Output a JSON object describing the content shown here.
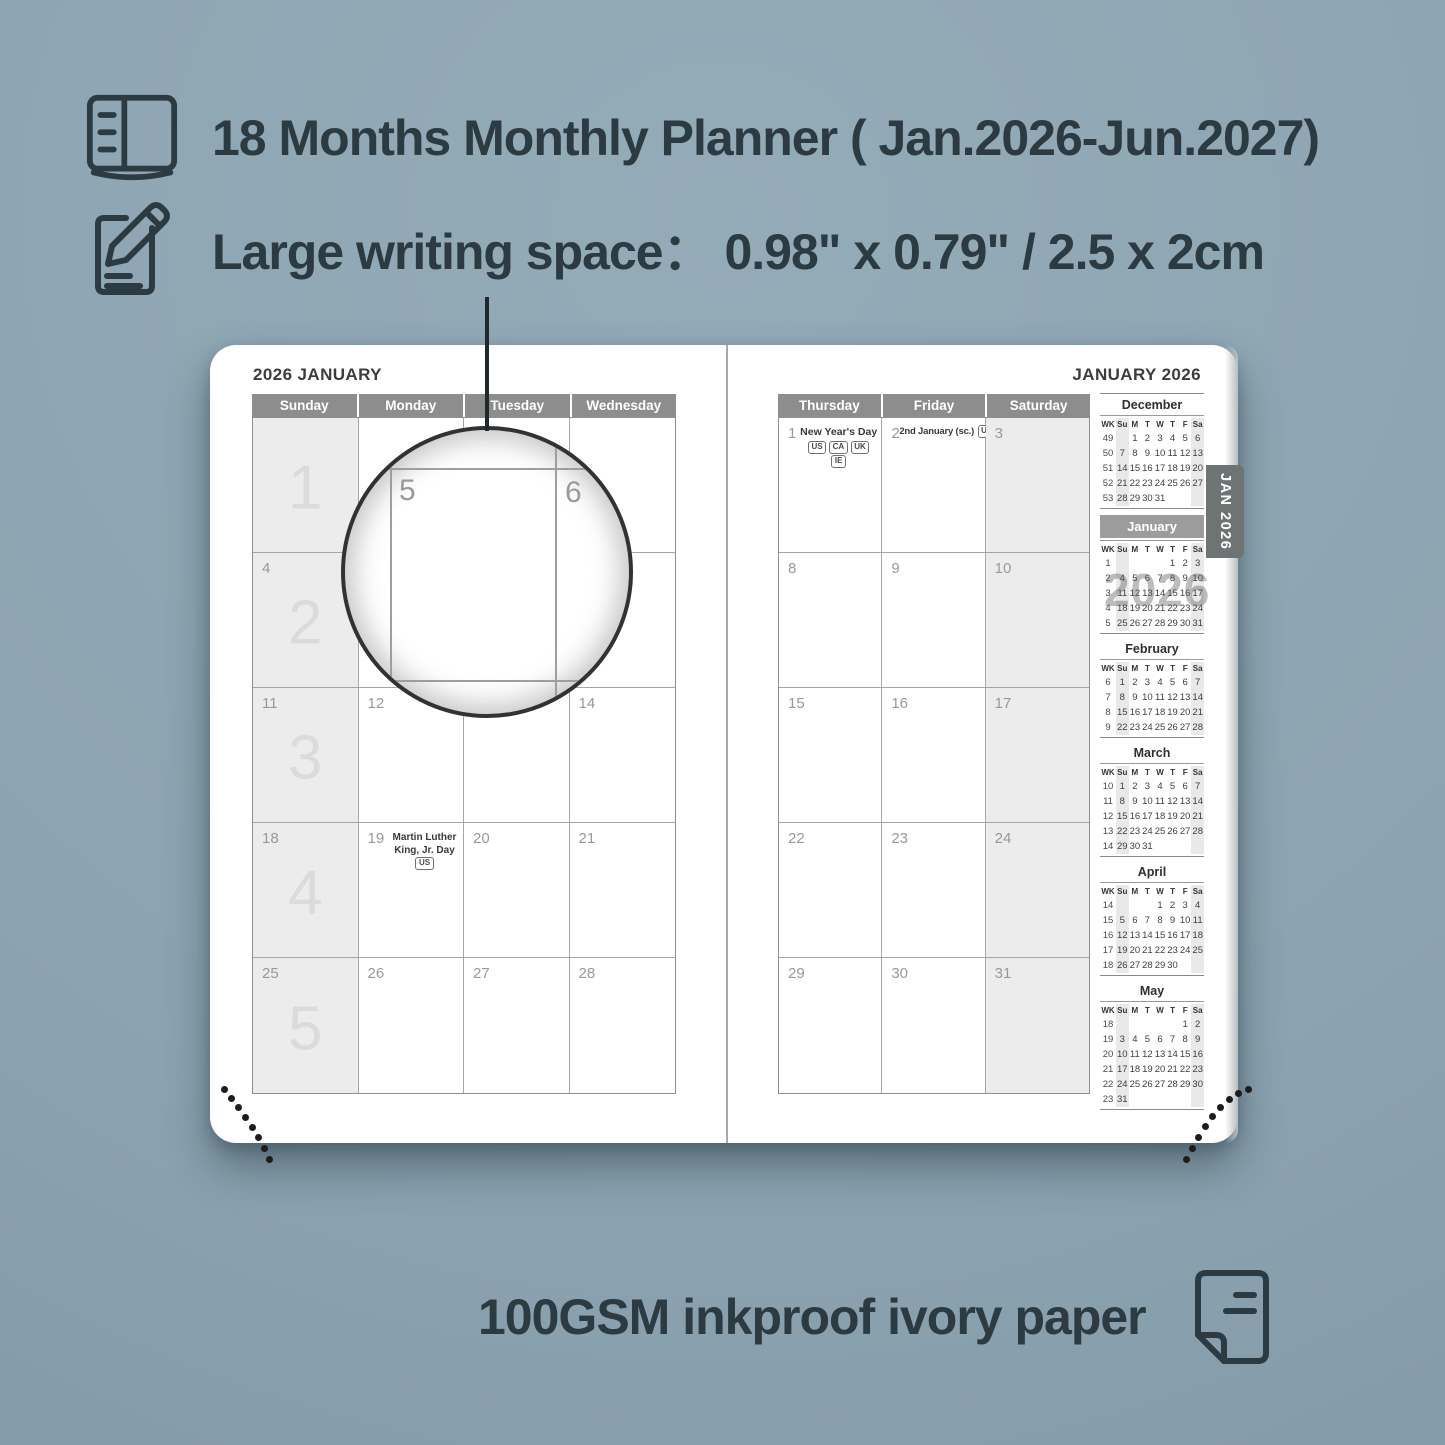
{
  "colors": {
    "background": "#8FA6B3",
    "text_dark": "#2C3A41",
    "day_header_bar": "#8D8D8D",
    "weekend_shade": "#ECECEC",
    "tab_background": "#6E7373",
    "page_background": "#FFFFFF"
  },
  "features": {
    "line1": {
      "icon": "open-planner-icon",
      "text": "18 Months Monthly Planner ( Jan.2026-Jun.2027)"
    },
    "line2": {
      "icon": "pencil-edit-icon",
      "text": "Large writing space：  0.98\" x 0.79\" / 2.5 x 2cm"
    },
    "line3": {
      "icon": "paper-sheet-icon",
      "text": "100GSM inkproof ivory paper"
    }
  },
  "planner": {
    "left_page": {
      "title": "2026 JANUARY",
      "day_headers": [
        "Sunday",
        "Monday",
        "Tuesday",
        "Wednesday"
      ],
      "weeks": [
        {
          "week_number": "1",
          "dates": [
            "",
            "",
            "",
            ""
          ]
        },
        {
          "week_number": "2",
          "dates": [
            "4",
            "5",
            "6",
            "7"
          ]
        },
        {
          "week_number": "3",
          "dates": [
            "11",
            "12",
            "13",
            "14"
          ]
        },
        {
          "week_number": "4",
          "dates": [
            "18",
            "19",
            "20",
            "21"
          ]
        },
        {
          "week_number": "5",
          "dates": [
            "25",
            "26",
            "27",
            "28"
          ]
        }
      ],
      "holiday": {
        "date": "19",
        "name": "Martin Luther King, Jr. Day",
        "badges": [
          "US"
        ]
      }
    },
    "right_page": {
      "title": "JANUARY 2026",
      "day_headers": [
        "Thursday",
        "Friday",
        "Saturday"
      ],
      "weeks": [
        {
          "dates": [
            "1",
            "2",
            "3"
          ]
        },
        {
          "dates": [
            "8",
            "9",
            "10"
          ]
        },
        {
          "dates": [
            "15",
            "16",
            "17"
          ]
        },
        {
          "dates": [
            "22",
            "23",
            "24"
          ]
        },
        {
          "dates": [
            "29",
            "30",
            "31"
          ]
        }
      ],
      "holidays": [
        {
          "date": "1",
          "name": "New Year's Day",
          "badges": [
            "US",
            "CA",
            "UK",
            "IE"
          ]
        },
        {
          "date": "2",
          "name": "2nd January (sc.)",
          "badges": [
            "UK"
          ]
        }
      ]
    },
    "magnifier": {
      "left_date": "5",
      "right_date": "6"
    },
    "side_tab": "JAN 2026",
    "watermark": "2026",
    "mini_calendar_header": [
      "WK",
      "Su",
      "M",
      "T",
      "W",
      "T",
      "F",
      "Sa"
    ],
    "mini_calendars": [
      {
        "month": "December",
        "highlighted": false,
        "weeks": [
          [
            "49",
            "",
            "1",
            "2",
            "3",
            "4",
            "5",
            "6"
          ],
          [
            "50",
            "7",
            "8",
            "9",
            "10",
            "11",
            "12",
            "13"
          ],
          [
            "51",
            "14",
            "15",
            "16",
            "17",
            "18",
            "19",
            "20"
          ],
          [
            "52",
            "21",
            "22",
            "23",
            "24",
            "25",
            "26",
            "27"
          ],
          [
            "53",
            "28",
            "29",
            "30",
            "31",
            "",
            "",
            ""
          ]
        ]
      },
      {
        "month": "January",
        "highlighted": true,
        "weeks": [
          [
            "1",
            "",
            "",
            "",
            "",
            "1",
            "2",
            "3"
          ],
          [
            "2",
            "4",
            "5",
            "6",
            "7",
            "8",
            "9",
            "10"
          ],
          [
            "3",
            "11",
            "12",
            "13",
            "14",
            "15",
            "16",
            "17"
          ],
          [
            "4",
            "18",
            "19",
            "20",
            "21",
            "22",
            "23",
            "24"
          ],
          [
            "5",
            "25",
            "26",
            "27",
            "28",
            "29",
            "30",
            "31"
          ]
        ]
      },
      {
        "month": "February",
        "highlighted": false,
        "weeks": [
          [
            "6",
            "1",
            "2",
            "3",
            "4",
            "5",
            "6",
            "7"
          ],
          [
            "7",
            "8",
            "9",
            "10",
            "11",
            "12",
            "13",
            "14"
          ],
          [
            "8",
            "15",
            "16",
            "17",
            "18",
            "19",
            "20",
            "21"
          ],
          [
            "9",
            "22",
            "23",
            "24",
            "25",
            "26",
            "27",
            "28"
          ]
        ]
      },
      {
        "month": "March",
        "highlighted": false,
        "weeks": [
          [
            "10",
            "1",
            "2",
            "3",
            "4",
            "5",
            "6",
            "7"
          ],
          [
            "11",
            "8",
            "9",
            "10",
            "11",
            "12",
            "13",
            "14"
          ],
          [
            "12",
            "15",
            "16",
            "17",
            "18",
            "19",
            "20",
            "21"
          ],
          [
            "13",
            "22",
            "23",
            "24",
            "25",
            "26",
            "27",
            "28"
          ],
          [
            "14",
            "29",
            "30",
            "31",
            "",
            "",
            "",
            ""
          ]
        ]
      },
      {
        "month": "April",
        "highlighted": false,
        "weeks": [
          [
            "14",
            "",
            "",
            "",
            "1",
            "2",
            "3",
            "4"
          ],
          [
            "15",
            "5",
            "6",
            "7",
            "8",
            "9",
            "10",
            "11"
          ],
          [
            "16",
            "12",
            "13",
            "14",
            "15",
            "16",
            "17",
            "18"
          ],
          [
            "17",
            "19",
            "20",
            "21",
            "22",
            "23",
            "24",
            "25"
          ],
          [
            "18",
            "26",
            "27",
            "28",
            "29",
            "30",
            "",
            ""
          ]
        ]
      },
      {
        "month": "May",
        "highlighted": false,
        "weeks": [
          [
            "18",
            "",
            "",
            "",
            "",
            "",
            "1",
            "2"
          ],
          [
            "19",
            "3",
            "4",
            "5",
            "6",
            "7",
            "8",
            "9"
          ],
          [
            "20",
            "10",
            "11",
            "12",
            "13",
            "14",
            "15",
            "16"
          ],
          [
            "21",
            "17",
            "18",
            "19",
            "20",
            "21",
            "22",
            "23"
          ],
          [
            "22",
            "24",
            "25",
            "26",
            "27",
            "28",
            "29",
            "30"
          ],
          [
            "23",
            "31",
            "",
            "",
            "",
            "",
            "",
            ""
          ]
        ]
      }
    ]
  }
}
